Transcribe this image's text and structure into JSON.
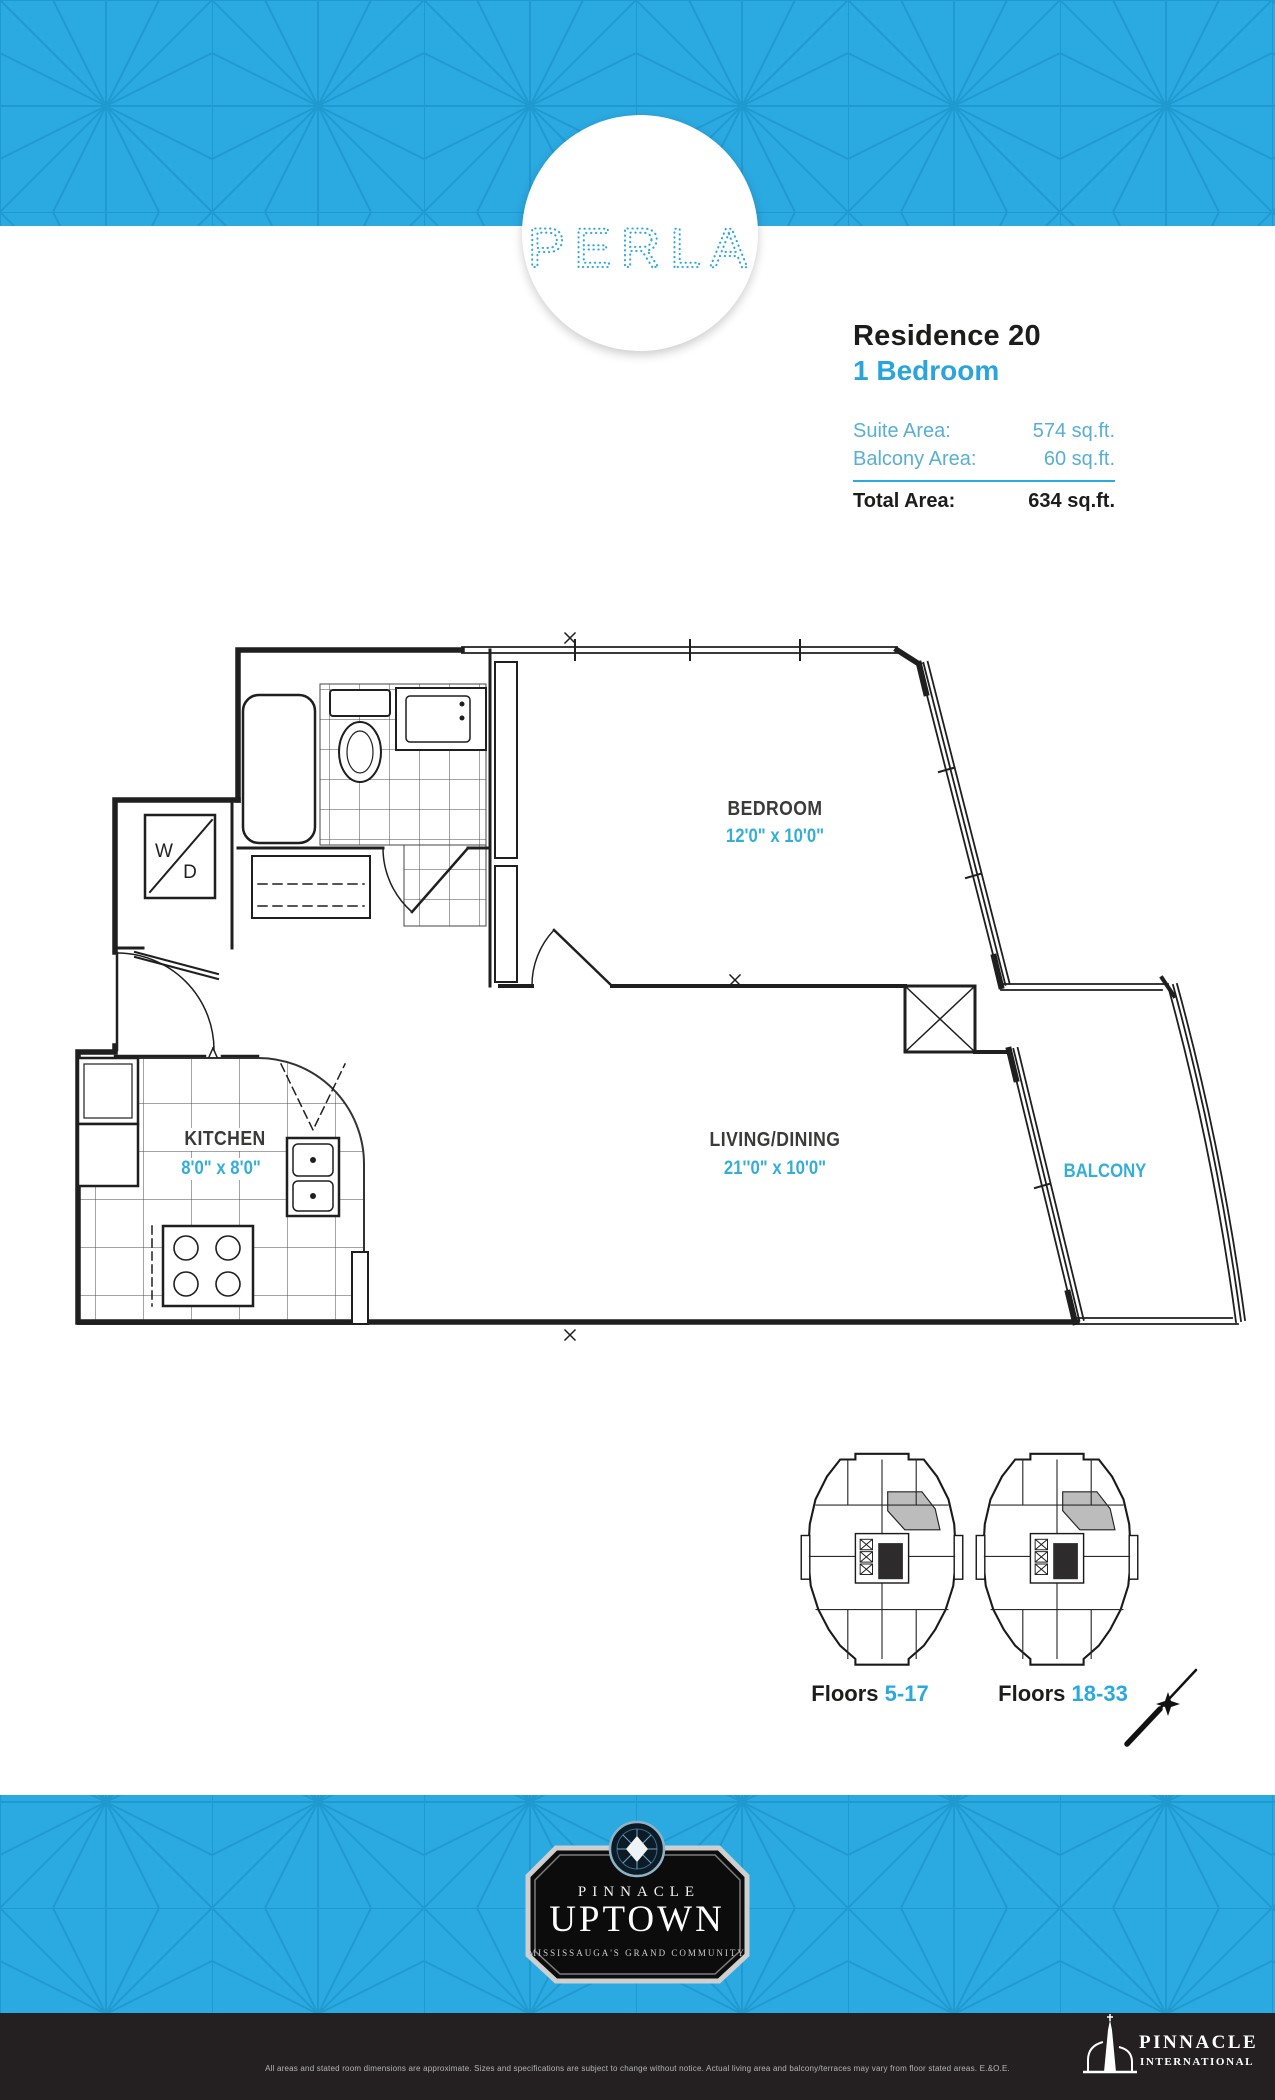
{
  "brand": {
    "logo_text": "PERLA"
  },
  "residence": {
    "title": "Residence 20",
    "subtitle": "1 Bedroom",
    "rows": [
      {
        "label": "Suite Area:",
        "value": "574 sq.ft."
      },
      {
        "label": "Balcony Area:",
        "value": "60 sq.ft."
      }
    ],
    "total_label": "Total Area:",
    "total_value": "634 sq.ft."
  },
  "floorplan": {
    "bedroom": {
      "name": "BEDROOM",
      "dims": "12'0\" x 10'0\""
    },
    "living": {
      "name": "LIVING/DINING",
      "dims": "21''0\" x 10'0\""
    },
    "kitchen": {
      "name": "KITCHEN",
      "dims": "8'0\" x 8'0\""
    },
    "balcony": {
      "name": "BALCONY"
    },
    "washer": "W",
    "dryer": "D"
  },
  "keyplans": {
    "left": {
      "label": "Floors",
      "range": "5-17"
    },
    "right": {
      "label": "Floors",
      "range": "18-33"
    }
  },
  "badge": {
    "brand": "PINNACLE",
    "name": "UPTOWN",
    "tagline": "MISSISSAUGA'S GRAND COMMUNITY"
  },
  "footer": {
    "disclaimer": "All areas and stated room dimensions are approximate. Sizes and specifications are subject to change without notice. Actual living area and balcony/terraces may vary from floor stated areas. E.&O.E.",
    "logo_line1": "PINNACLE",
    "logo_line2": "INTERNATIONAL"
  },
  "colors": {
    "accent": "#2ba9e1",
    "pattern_line": "#1b95cb",
    "footer_bg": "#242021"
  }
}
